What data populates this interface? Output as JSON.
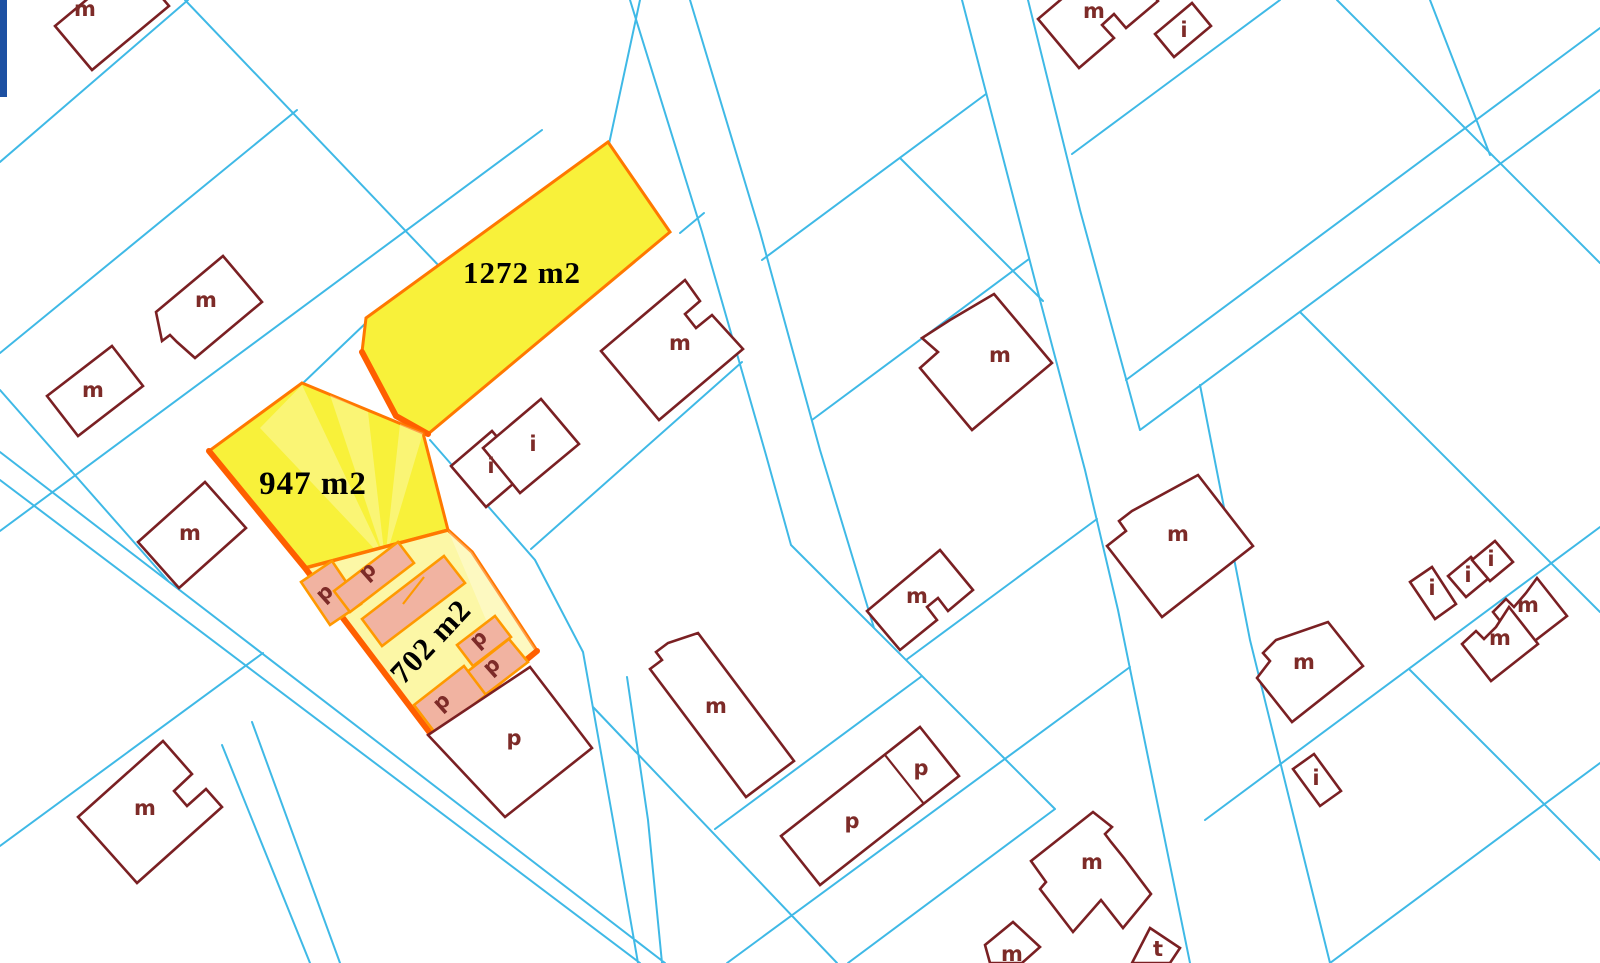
{
  "map": {
    "colors": {
      "boundary": "#3fb9e6",
      "building_outline": "#7a2023",
      "building_label": "#7d2b28",
      "highlight_fill": "#f8f13a",
      "highlight_fill_pale": "#fcf7a6",
      "highlight_border": "#ff7800",
      "highlight_border_deep": "#ff5f00",
      "selected_building_fill": "#f1b3a1",
      "selected_building_border": "#ff9900",
      "area_label_color": "#000000",
      "accent_bar": "#1d50a2"
    },
    "parcels": [
      {
        "id": "parcel-1272",
        "area_label": "1272 m2"
      },
      {
        "id": "parcel-947",
        "area_label": "947 m2"
      },
      {
        "id": "parcel-702",
        "area_label": "702 m2"
      }
    ],
    "building_labels": [
      {
        "t": "m",
        "x": 85,
        "y": 16,
        "r": 0
      },
      {
        "t": "m",
        "x": 206,
        "y": 307,
        "r": 0
      },
      {
        "t": "m",
        "x": 93,
        "y": 397,
        "r": 0
      },
      {
        "t": "m",
        "x": 190,
        "y": 540,
        "r": 0
      },
      {
        "t": "m",
        "x": 145,
        "y": 815,
        "r": 0
      },
      {
        "t": "m",
        "x": 680,
        "y": 350,
        "r": 0
      },
      {
        "t": "i",
        "x": 491,
        "y": 473,
        "r": 0
      },
      {
        "t": "i",
        "x": 533,
        "y": 451,
        "r": 0
      },
      {
        "t": "m",
        "x": 1000,
        "y": 362,
        "r": 0
      },
      {
        "t": "m",
        "x": 1178,
        "y": 541,
        "r": 0
      },
      {
        "t": "m",
        "x": 1094,
        "y": 18,
        "r": 0
      },
      {
        "t": "i",
        "x": 1184,
        "y": 37,
        "r": 0
      },
      {
        "t": "m",
        "x": 716,
        "y": 713,
        "r": 0
      },
      {
        "t": "m",
        "x": 917,
        "y": 603,
        "r": 0
      },
      {
        "t": "p",
        "x": 852,
        "y": 828,
        "r": 0
      },
      {
        "t": "p",
        "x": 921,
        "y": 775,
        "r": 0
      },
      {
        "t": "p",
        "x": 514,
        "y": 745,
        "r": 0
      },
      {
        "t": "m",
        "x": 1304,
        "y": 669,
        "r": 0
      },
      {
        "t": "i",
        "x": 1316,
        "y": 785,
        "r": 0
      },
      {
        "t": "m",
        "x": 1092,
        "y": 869,
        "r": 0
      },
      {
        "t": "m",
        "x": 1012,
        "y": 961,
        "r": 0
      },
      {
        "t": "t",
        "x": 1158,
        "y": 956,
        "r": 0
      },
      {
        "t": "i",
        "x": 1432,
        "y": 595,
        "r": 0
      },
      {
        "t": "i",
        "x": 1468,
        "y": 582,
        "r": 0
      },
      {
        "t": "i",
        "x": 1491,
        "y": 566,
        "r": 0
      },
      {
        "t": "m",
        "x": 1528,
        "y": 612,
        "r": 0
      },
      {
        "t": "m",
        "x": 1500,
        "y": 645,
        "r": 0
      },
      {
        "t": "p",
        "x": 329,
        "y": 598,
        "r": -42
      },
      {
        "t": "p",
        "x": 372,
        "y": 576,
        "r": -42
      },
      {
        "t": "p",
        "x": 483,
        "y": 644,
        "r": -42
      },
      {
        "t": "p",
        "x": 496,
        "y": 671,
        "r": -42
      },
      {
        "t": "p",
        "x": 446,
        "y": 707,
        "r": -42
      }
    ]
  }
}
